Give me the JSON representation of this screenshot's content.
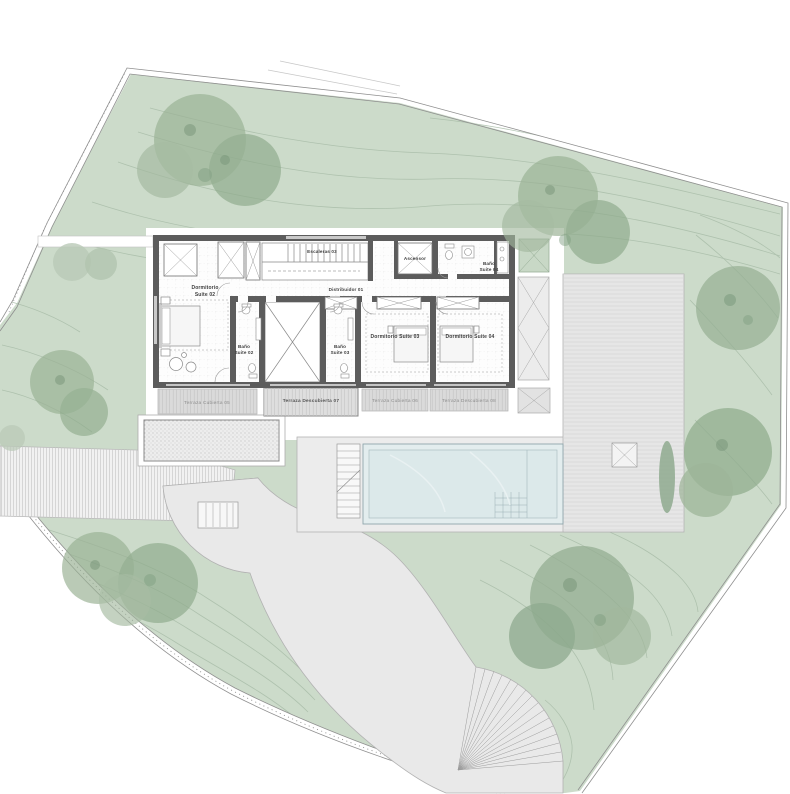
{
  "plan": {
    "rooms": {
      "dormitorio_suite_02_l1": "Dormitorio",
      "dormitorio_suite_02_l2": "Suite 02",
      "escaleras": "Escaleras 03",
      "distribuidor": "Distribuidor 01",
      "ascensor": "Ascensor",
      "bano_04_l1": "Baño",
      "bano_04_l2": "Suite 04",
      "bano_02_l1": "Baño",
      "bano_02_l2": "Suite 02",
      "bano_03_l1": "Baño",
      "bano_03_l2": "Suite 03",
      "dormitorio_suite_03": "Dormitorio Suite 03",
      "dormitorio_suite_04": "Dormitorio Suite 04"
    },
    "terraces": {
      "t1": "Terraza Cubierta 05",
      "t2": "Terraza Descubierta 07",
      "t3": "Terraza Cubierta 06",
      "t4": "Terraza Descubierta 08"
    }
  },
  "colors": {
    "site_green": "#ccdbca",
    "tree_green": "#93ad91",
    "hardscape_gray": "#e8e8e8",
    "pool_water": "#dce9ea",
    "wall_dark": "#5c5c5c"
  }
}
